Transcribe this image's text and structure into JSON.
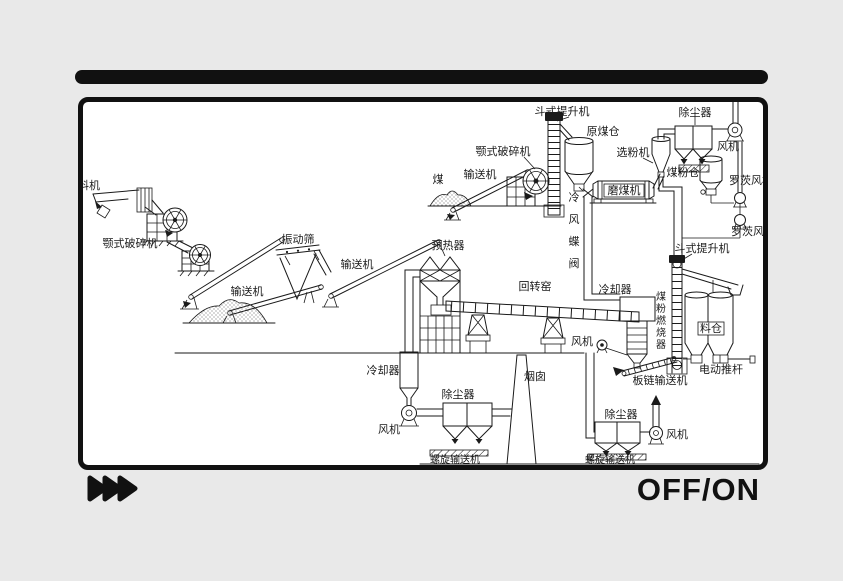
{
  "palette": {
    "background": "#e9e9e9",
    "ink": "#111111",
    "line_color": "#1a1a1a",
    "canvas": "#ffffff"
  },
  "controls": {
    "fast_forward_icon": "fast-forward",
    "power_label": "OFF/ON"
  },
  "diagram": {
    "labels": {
      "feeder_left": "料机",
      "jaw_crusher_left": "颚式破碎机",
      "conveyor_left_lower": "输送机",
      "vibrating_screen": "振动筛",
      "conveyor_left_upper": "输送机",
      "coal": "煤",
      "conveyor_top": "输送机",
      "jaw_crusher_top": "颚式破碎机",
      "bucket_elevator_top": "斗式提升机",
      "raw_coal_bunker": "原煤仓",
      "cold_air_butterfly_valve": "冷风蝶阀",
      "coal_mill": "磨煤机",
      "classifier": "选粉机",
      "dust_collector_top_right": "除尘器",
      "fan_top_right": "风机",
      "coal_powder_bunker": "煤粉仓",
      "roots_blower_1": "罗茨风机",
      "roots_blower_2": "罗茨风机",
      "preheater": "预热器",
      "rotary_kiln": "回转窑",
      "cooler_kiln": "冷却器",
      "fan_mid": "风机",
      "coal_powder_burner": "煤粉燃烧器",
      "bucket_elevator_right": "斗式提升机",
      "material_bunker": "料仓",
      "electric_push_rod": "电动推杆",
      "plate_chain_conveyor": "板链输送机",
      "cooler_bottom": "冷却器",
      "fan_bottom_left": "风机",
      "dust_collector_bottom_middle": "除尘器",
      "screw_conveyor_bottom_middle": "螺旋输送机",
      "chimney": "烟囱",
      "dust_collector_bottom_right": "除尘器",
      "fan_bottom_right": "风机",
      "screw_conveyor_bottom_right": "螺旋输送机"
    }
  }
}
